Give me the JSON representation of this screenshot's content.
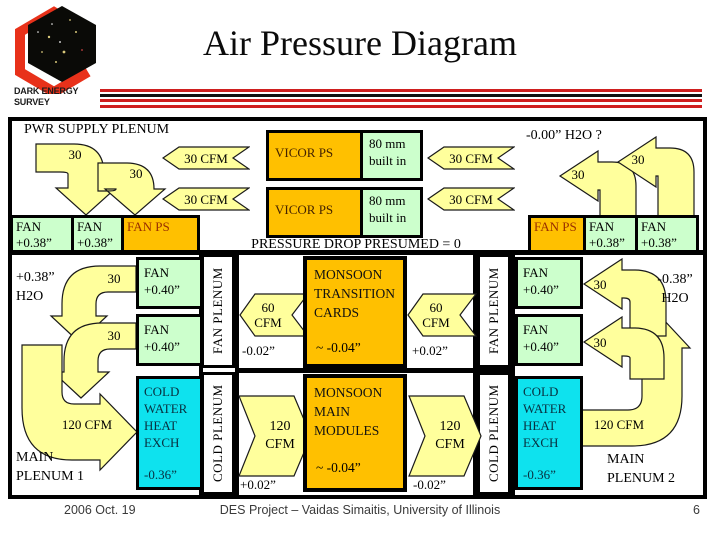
{
  "header": {
    "title": "Air Pressure Diagram",
    "logo_line1": "DARK ENERGY",
    "logo_line2": "SURVEY"
  },
  "colors": {
    "arrow_yellow": "#ffff9c",
    "box_orange": "#ffc000",
    "box_green": "#ccffcc",
    "box_cyan": "#0ee2ee",
    "accent_red": "#cf1f1f"
  },
  "top_band": {
    "pwr_supply_label": "PWR SUPPLY PLENUM",
    "h2o_note": "-0.00” H2O ?",
    "pressure_note": "PRESSURE DROP PRESUMED = 0",
    "flow_a1": "30",
    "flow_a2": "30",
    "flow_b1": "30",
    "flow_b2": "30",
    "cfm_left_1": "30 CFM",
    "cfm_left_2": "30 CFM",
    "cfm_right_1": "30 CFM",
    "cfm_right_2": "30 CFM",
    "vicor_1": {
      "name": "VICOR  PS",
      "note_line1": "80 mm",
      "note_line2": "built in"
    },
    "vicor_2": {
      "name": "VICOR PS",
      "note_line1": "80 mm",
      "note_line2": "built in"
    },
    "fan_left_1": {
      "line1": "FAN",
      "line2": "+0.38”"
    },
    "fan_left_2": {
      "line1": "FAN",
      "line2": "+0.38”"
    },
    "fan_ps_left": "FAN PS",
    "fan_ps_right": "FAN PS",
    "fan_right_1": {
      "line1": "FAN",
      "line2": "+0.38”"
    },
    "fan_right_2": {
      "line1": "FAN",
      "line2": "+0.38”"
    }
  },
  "middle_band": {
    "h2o_left": {
      "line1": "+0.38”",
      "line2": "H2O"
    },
    "h2o_right": {
      "line1": "-0.38”",
      "line2": "H2O"
    },
    "flow_c1": "30",
    "flow_c2": "30",
    "flow_f1": "30",
    "flow_f2": "30",
    "fan40_l1": {
      "line1": "FAN",
      "line2": "+0.40”"
    },
    "fan40_l2": {
      "line1": "FAN",
      "line2": "+0.40”"
    },
    "fan40_r1": {
      "line1": "FAN",
      "line2": "+0.40”"
    },
    "fan40_r2": {
      "line1": "FAN",
      "line2": "+0.40”"
    },
    "fan_plenum_left": "FAN PLENUM",
    "fan_plenum_right": "FAN PLENUM",
    "cfm60_left": {
      "line1": "60",
      "line2": "CFM"
    },
    "cfm60_right": {
      "line1": "60",
      "line2": "CFM"
    },
    "p_left": "-0.02”",
    "p_right": "+0.02”",
    "monsoon_transition": {
      "line1": "MONSOON",
      "line2": "TRANSITION",
      "line3": "CARDS",
      "pressure": "~  -0.04”"
    }
  },
  "bottom_band": {
    "flow120_left_label": "120 CFM",
    "flow120_right_label": "120 CFM",
    "hx_left": {
      "line1": "COLD",
      "line2": "WATER",
      "line3": "HEAT",
      "line4": "EXCH",
      "pressure": "-0.36”"
    },
    "hx_right": {
      "line1": "COLD",
      "line2": "WATER",
      "line3": "HEAT",
      "line4": "EXCH",
      "pressure": "-0.36”"
    },
    "cold_plenum_left": "COLD PLENUM",
    "cold_plenum_right": "COLD PLENUM",
    "cfm120_left": {
      "line1": "120",
      "line2": "CFM"
    },
    "cfm120_right": {
      "line1": "120",
      "line2": "CFM"
    },
    "p_left": "+0.02”",
    "p_right": "-0.02”",
    "monsoon_main": {
      "line1": "MONSOON",
      "line2": "MAIN",
      "line3": "MODULES",
      "pressure": "~  -0.04”"
    },
    "main_plenum_1": {
      "line1": "MAIN",
      "line2": "PLENUM 1"
    },
    "main_plenum_2": {
      "line1": "MAIN",
      "line2": "PLENUM 2"
    }
  },
  "footer": {
    "date": "2006 Oct. 19",
    "credit": "DES Project – Vaidas Simaitis,  University of Illinois",
    "page_number": "6"
  }
}
